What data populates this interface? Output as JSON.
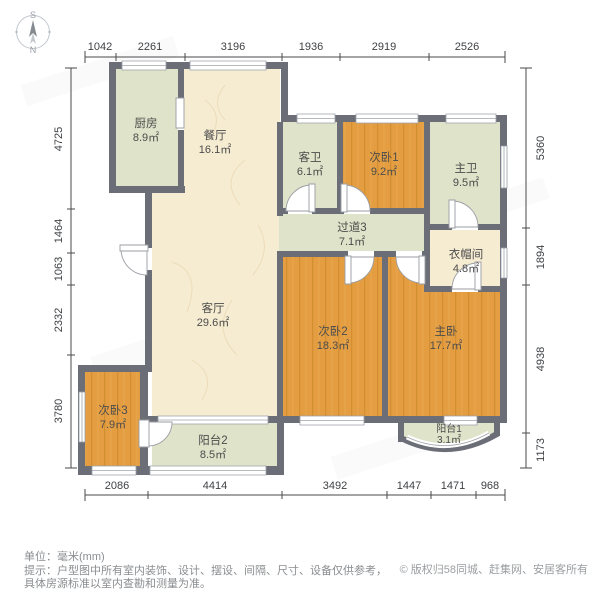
{
  "compass": {
    "south": "S",
    "north": "N"
  },
  "rooms": [
    {
      "name": "厨房",
      "area": "8.9㎡"
    },
    {
      "name": "餐厅",
      "area": "16.1㎡"
    },
    {
      "name": "客卫",
      "area": "6.1㎡"
    },
    {
      "name": "次卧1",
      "area": "9.2㎡"
    },
    {
      "name": "主卫",
      "area": "9.5㎡"
    },
    {
      "name": "过道3",
      "area": "7.1㎡"
    },
    {
      "name": "衣帽间",
      "area": "4.8㎡"
    },
    {
      "name": "客厅",
      "area": "29.6㎡"
    },
    {
      "name": "次卧2",
      "area": "18.3㎡"
    },
    {
      "name": "主卧",
      "area": "17.7㎡"
    },
    {
      "name": "次卧3",
      "area": "7.9㎡"
    },
    {
      "name": "阳台2",
      "area": "8.5㎡"
    },
    {
      "name": "阳台1",
      "area": "3.1㎡"
    }
  ],
  "dimensions": {
    "top": [
      "1042",
      "2261",
      "3196",
      "1936",
      "2919",
      "2526"
    ],
    "left": [
      "4725",
      "1464",
      "1063",
      "2332",
      "3780"
    ],
    "right": [
      "5360",
      "1894",
      "4938",
      "1173"
    ],
    "bottom": [
      "2086",
      "4414",
      "3492",
      "1447",
      "1471",
      "968"
    ]
  },
  "footer": {
    "unit": "单位：毫米(mm)",
    "tip_line1": "提示：户型图中所有室内装饰、设计、摆设、间隔、尺寸、设备仅供参考，",
    "tip_line2": "具体房源标准以室内查勘和测量为准。",
    "copyright": "© 版权归58同城、赶集网、安居客所有"
  },
  "colors": {
    "wall": "#6b6e76",
    "floor_wood": "#e49e41",
    "floor_tile_green": "#dfe3c9",
    "floor_marble_cream": "#f6ecd2",
    "dimension_text": "#3f4144",
    "footer_text": "#8a8d90"
  }
}
